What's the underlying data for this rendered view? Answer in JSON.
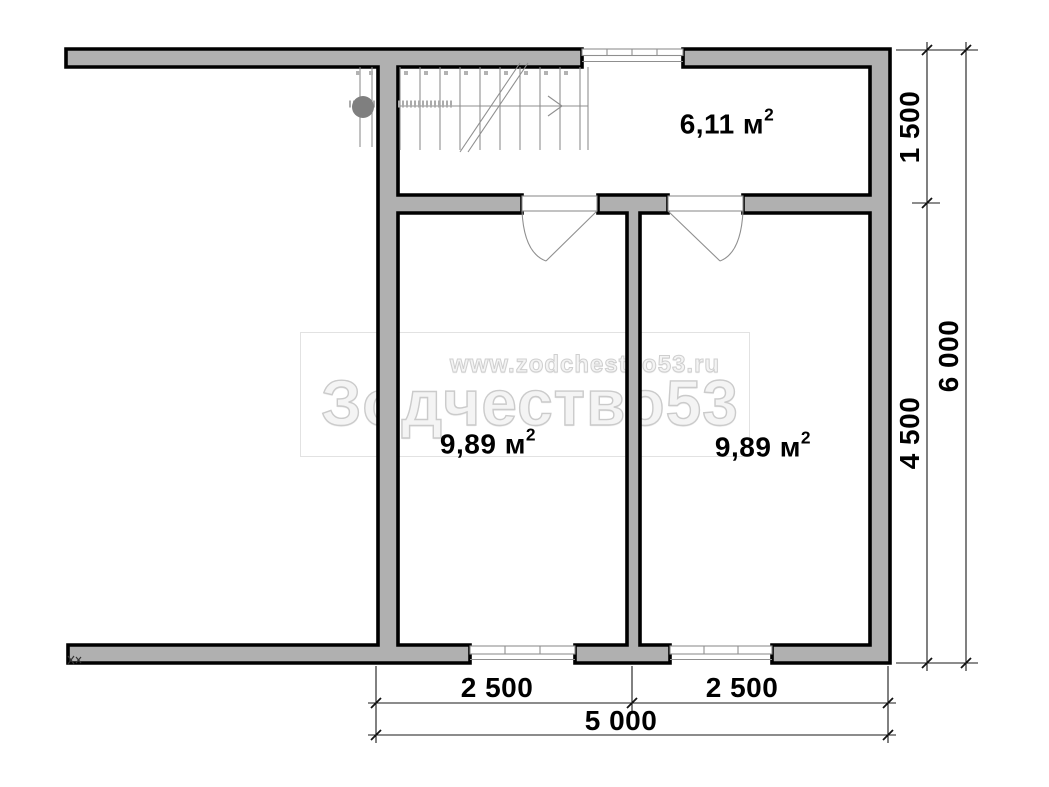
{
  "colors": {
    "wall_fill": "#b0b0b0",
    "wall_stroke": "#000000",
    "thin_line": "#8f8f8f"
  },
  "rooms": [
    {
      "label": "6,11 м",
      "sup": "2"
    },
    {
      "label": "9,89 м",
      "sup": "2"
    },
    {
      "label": "9,89 м",
      "sup": "2"
    }
  ],
  "dimensions": {
    "right_inner_top": "1 500",
    "right_inner_bottom": "4 500",
    "right_outer": "6 000",
    "bottom_left": "2 500",
    "bottom_right": "2 500",
    "bottom_total": "5 000"
  },
  "watermark": {
    "url": "www.zodchestvo53.ru",
    "brand": "Зодчество53"
  }
}
